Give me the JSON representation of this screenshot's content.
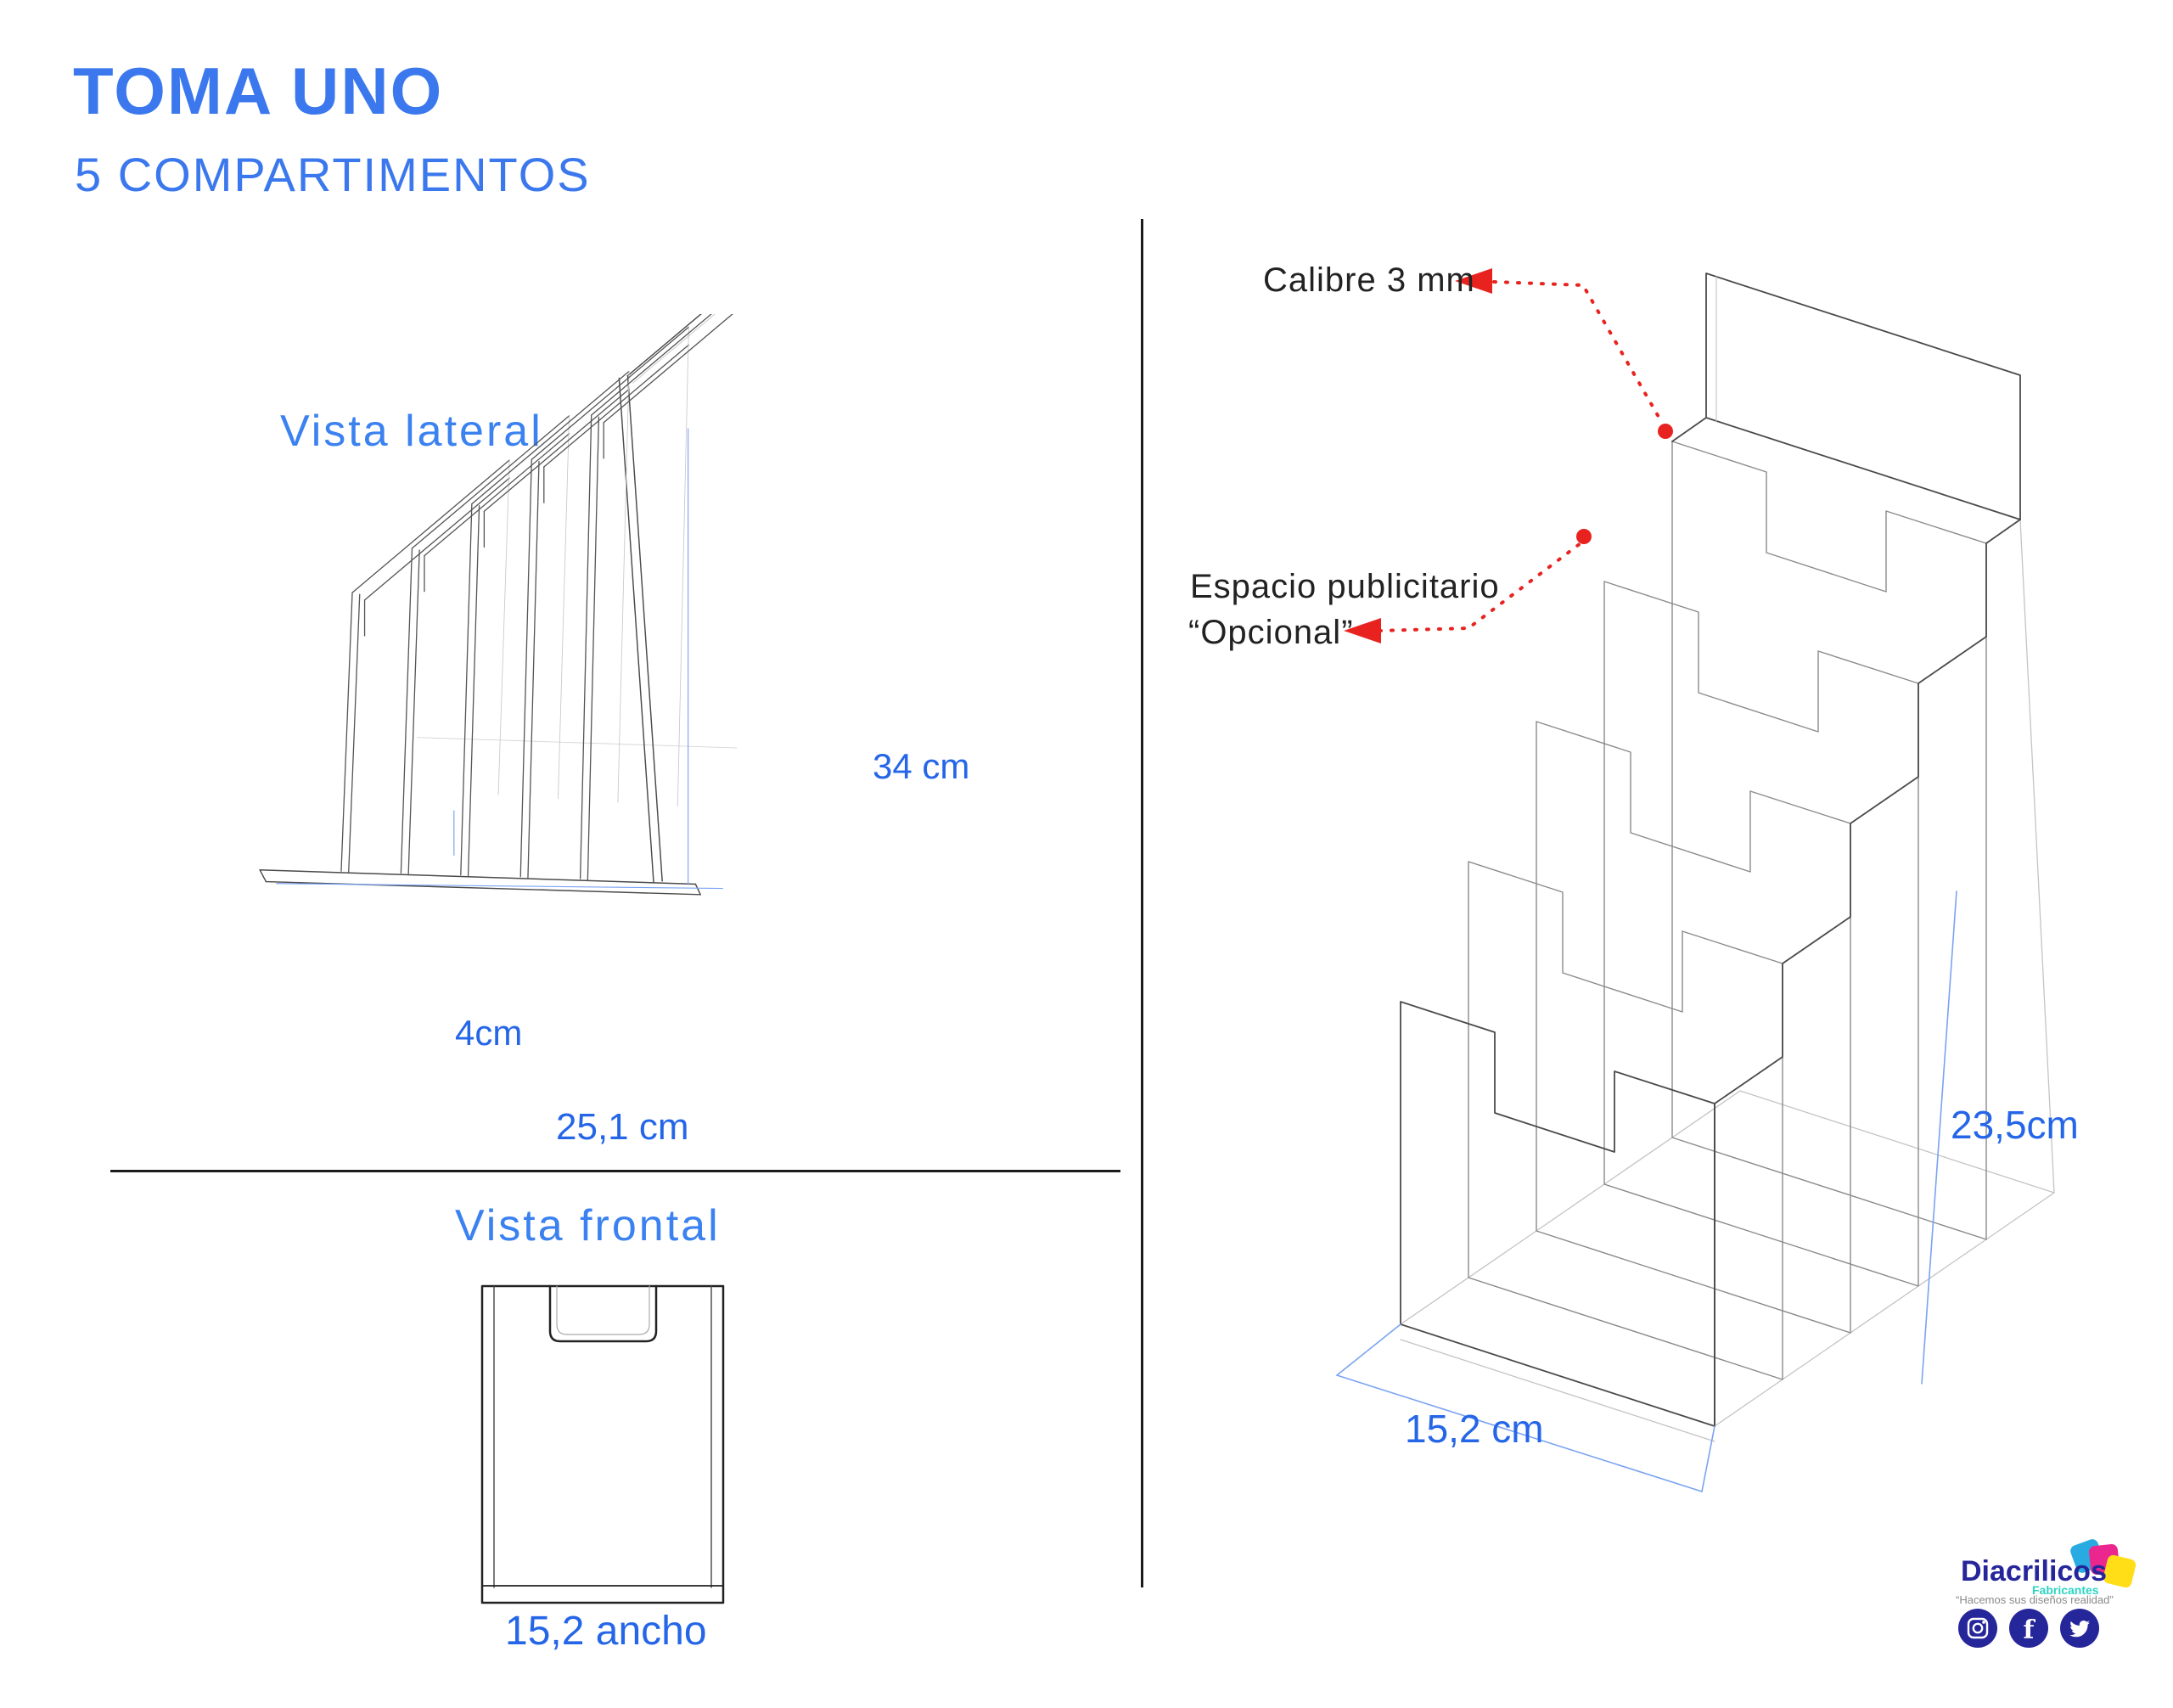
{
  "header": {
    "title": "TOMA UNO",
    "subtitle": "5 COMPARTIMENTOS"
  },
  "lateral": {
    "label": "Vista lateral",
    "dim_height": "34 cm",
    "dim_pocket": "4cm",
    "dim_depth": "25,1 cm"
  },
  "frontal": {
    "label": "Vista frontal",
    "dim_width": "15,2 ancho"
  },
  "iso": {
    "caliber": "Calibre 3 mm",
    "ad_line1": "Espacio publicitario",
    "ad_line2": "“Opcional”",
    "dim_width": "15,2 cm",
    "dim_height": "23,5cm"
  },
  "logo": {
    "brand": "Diacrilicos",
    "sub": "Fabricantes",
    "tagline": "“Hacemos sus diseños realidad”",
    "fb_letter": "f"
  },
  "colors": {
    "heading_blue": "#3b78ee",
    "dim_blue": "#2566e8",
    "line_blue": "#7aa3f2",
    "red": "#e8231f",
    "ink": "#4a4a4a",
    "light_ink": "#bdbdbd",
    "navy": "#26269b",
    "teal": "#2bd4c3",
    "gray": "#8a8a8a",
    "sq_blue": "#29abe2",
    "sq_pink": "#ec268f",
    "sq_yellow": "#ffde17"
  }
}
